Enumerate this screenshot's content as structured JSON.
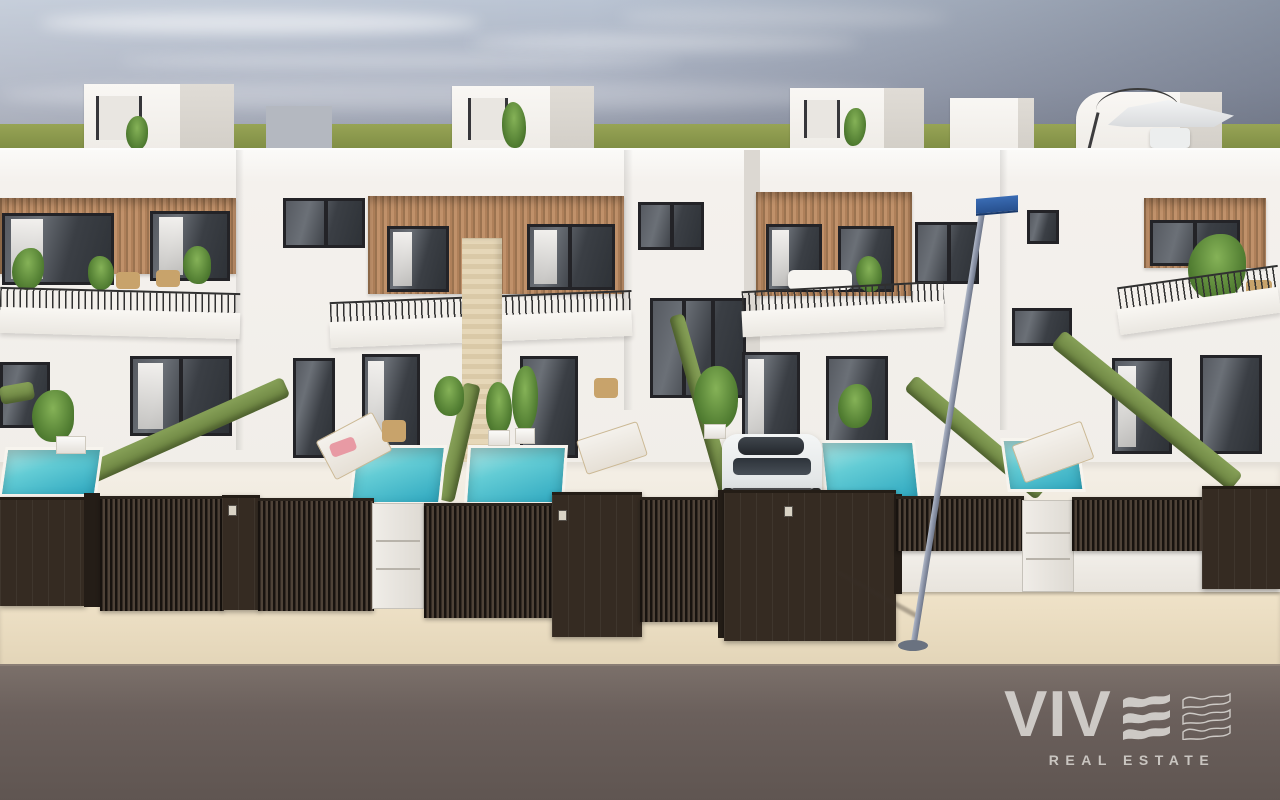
{
  "watermark": {
    "wordmark_text": "VIV",
    "wordmark_glyph": "wave-e-icon",
    "tagline": "REAL ESTATE",
    "color": "#d6d3cf"
  },
  "scene": {
    "type": "architectural-3d-render",
    "houses_visible": 4,
    "rooftop_volumes": 4,
    "pools_visible": 5,
    "cars_visible": 1,
    "street_lamp_count": 1
  },
  "palette": {
    "sky_top": "#bac4d3",
    "sky_corner_dark": "#6f7686",
    "horizon_grass": "#8a9750",
    "wall_white": "#f4f1ed",
    "wood_cladding": "#b28459",
    "window_frame": "#232327",
    "window_glass": "#3b3f45",
    "hedge_green": "#76914a",
    "pool_water": "#55c0cf",
    "terrace_floor": "#efe8dc",
    "fence_dark_brown": "#352b22",
    "utility_cabinet": "#e9e5df",
    "sidewalk_beige": "#e9dcc1",
    "road_asphalt": "#6b605c",
    "lamp_pole": "#8c94a8",
    "street_sign_blue": "#2f5fa6",
    "car_body": "#eef0f1"
  }
}
